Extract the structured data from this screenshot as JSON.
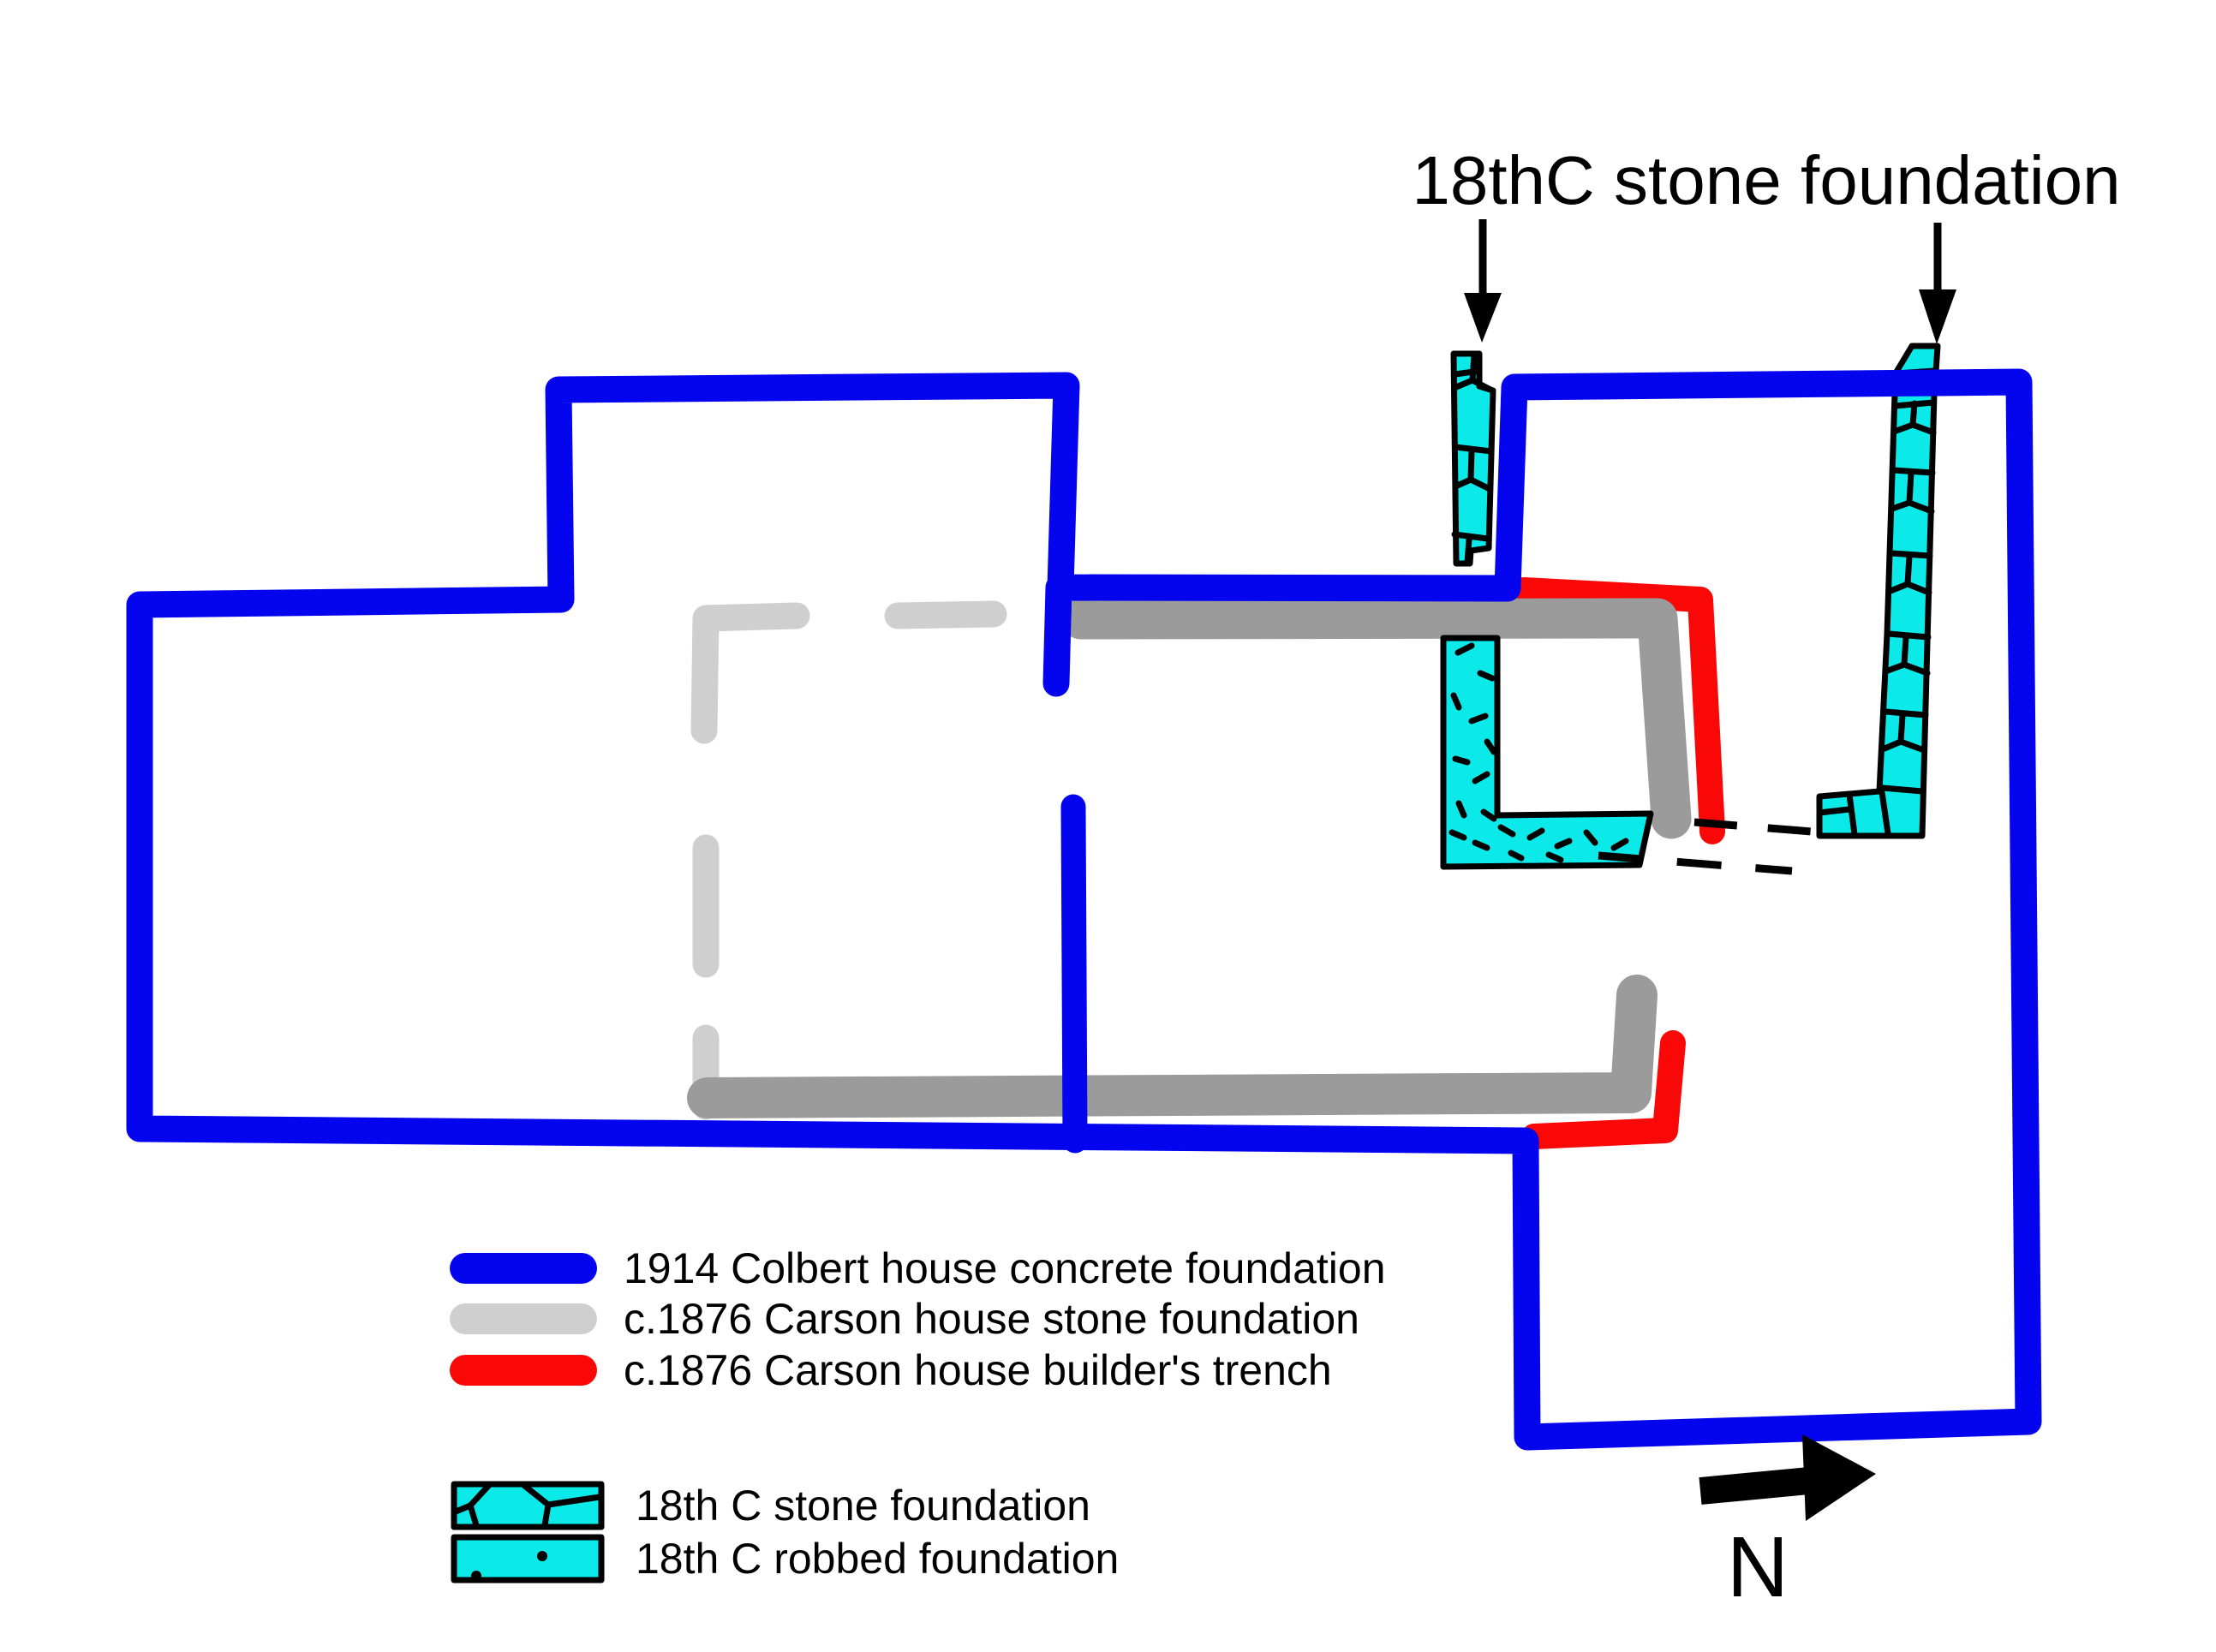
{
  "title": "18thC stone foundation",
  "compass": {
    "label": "N"
  },
  "legend": {
    "line_items": [
      {
        "label": "1914 Colbert house concrete foundation",
        "color": "#0404ee"
      },
      {
        "label": "c.1876 Carson house stone foundation",
        "color": "#cfcfcf"
      },
      {
        "label": "c.1876 Carson house builder's trench",
        "color": "#fa0707"
      }
    ],
    "patch_items": [
      {
        "label": "18th C stone foundation",
        "pattern": "stones",
        "fill": "#0be9e9"
      },
      {
        "label": "18th C robbed foundation",
        "pattern": "dots",
        "fill": "#0be9e9"
      }
    ]
  },
  "colors": {
    "concrete_blue": "#0404ee",
    "stone_gray_dark": "#9b9b9b",
    "stone_gray_light": "#cfcfcf",
    "trench_red": "#fa0707",
    "cyan_fill": "#0be9e9",
    "ink_black": "#000000"
  }
}
